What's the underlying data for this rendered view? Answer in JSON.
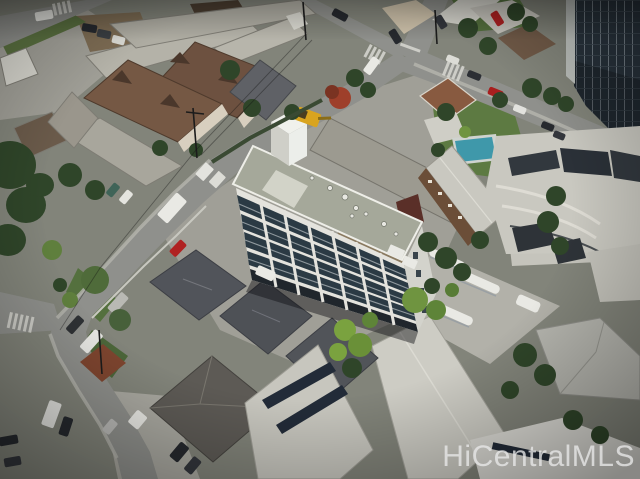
{
  "watermark": {
    "text": "HiCentralMLS",
    "color": "#e9e9e9"
  },
  "scene": {
    "description": "Oblique aerial drone photo of a Honolulu residential block: a white low-rise condo building with flat green-gray roof at center, surrounded by walk-up apartments, single-family homes with gray hip roofs, a swimming pool, stretch limousines in a lot, solar-panel roofs, tree-lined streets meeting at an intersection, and a dark glass high-rise tower with parking structure on the right.",
    "landmarks": [
      "central-condo-building",
      "walkup-apartment-rear",
      "brown-roof-apartments",
      "street-intersection",
      "front-street",
      "swimming-pool",
      "high-rise-tower",
      "parking-structure",
      "limousine-lot",
      "solar-roof-building",
      "hip-roof-houses",
      "excavator",
      "box-truck",
      "crosswalks",
      "utility-poles"
    ]
  },
  "palette": {
    "base": "#82847a",
    "street": "#8f908c",
    "sidewalk": "#b2b1a9",
    "concrete": "#a09f97",
    "lot": "#b2b1a9",
    "dirt": "#7c6b53",
    "dirtDark": "#4a3d30",
    "roofLightGray": "#b4b2a8",
    "roofWhite": "#d9d8d0",
    "roofBrown": "#6d5140",
    "wallCream": "#d8cfbf",
    "houseRoofDark": "#51545a",
    "centralWall": "#e4e3dd",
    "centralRoof": "#a5a89a",
    "windowDark": "#2b3a44",
    "carportDark": "#20262c",
    "walkupRoof": "#9c9a90",
    "walkupWall": "#6b4e38",
    "lawn": "#5d7a42",
    "treeDark": "#2f4529",
    "treeBright": "#7aa23f",
    "flowerRed": "#9e3f2a",
    "pool": "#3f98aa",
    "towerGlass": "#27313a",
    "towerFrame": "#6d777f",
    "parkingWhite": "#c9c8c0",
    "vehicleWhite": "#e9e9e4",
    "vehicleRed": "#b02222",
    "vehicleDark": "#26292e",
    "vehicleSilver": "#b9b9b6",
    "excavatorYellow": "#d9a41f",
    "solarPanel": "#222b38"
  }
}
